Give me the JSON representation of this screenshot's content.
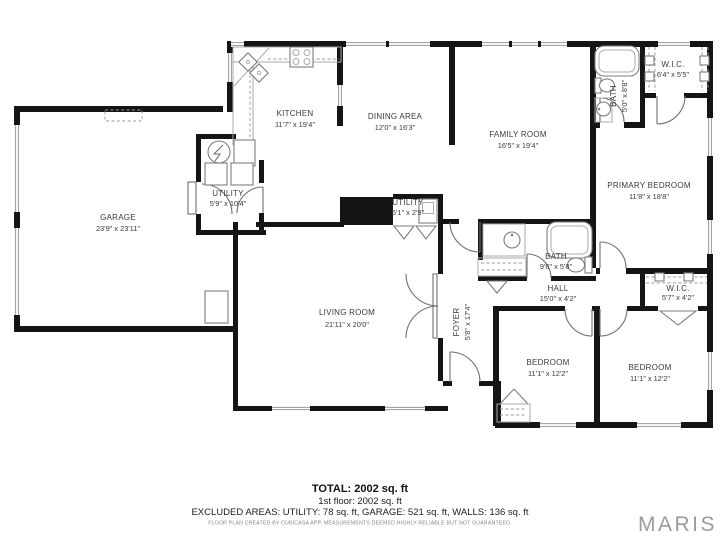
{
  "rooms": {
    "kitchen": {
      "name": "KITCHEN",
      "dims": "11'7\" x 19'4\""
    },
    "dining": {
      "name": "DINING AREA",
      "dims": "12'0\" x 16'3\""
    },
    "family": {
      "name": "FAMILY ROOM",
      "dims": "16'5\" x 19'4\""
    },
    "bath_top": {
      "name": "BATH",
      "dims": "5'0\" x 8'8\""
    },
    "wic_top": {
      "name": "W.I.C.",
      "dims": "6'4\" x 5'5\""
    },
    "primary": {
      "name": "PRIMARY BEDROOM",
      "dims": "11'8\" x 18'8\""
    },
    "garage": {
      "name": "GARAGE",
      "dims": "23'9\" x 23'11\""
    },
    "utility": {
      "name": "UTILITY",
      "dims": "5'9\" x 10'4\""
    },
    "utility_small": {
      "name": "UTILITY",
      "dims": "5'1\" x 2'9\""
    },
    "living": {
      "name": "LIVING ROOM",
      "dims": "21'11\" x 20'0\""
    },
    "foyer": {
      "name": "FOYER",
      "dims": "5'8\" x 17'4\""
    },
    "bath_mid": {
      "name": "BATH",
      "dims": "9'6\" x 5'8\""
    },
    "hall": {
      "name": "HALL",
      "dims": "15'0\" x 4'2\""
    },
    "wic_right": {
      "name": "W.I.C.",
      "dims": "5'7\" x 4'2\""
    },
    "bedroom_left": {
      "name": "BEDROOM",
      "dims": "11'1\" x 12'2\""
    },
    "bedroom_right": {
      "name": "BEDROOM",
      "dims": "11'1\" x 12'2\""
    }
  },
  "footer": {
    "total": "TOTAL: 2002 sq. ft",
    "floor": "1st floor: 2002 sq. ft",
    "excluded": "EXCLUDED AREAS: UTILITY: 78 sq. ft, GARAGE: 521 sq. ft, WALLS: 136 sq. ft",
    "disclaimer": "FLOOR PLAN CREATED BY CUBICASA APP. MEASUREMENTS DEEMED HIGHLY RELIABLE BUT NOT GUARANTEED.",
    "brand": "MARIS"
  },
  "colors": {
    "wall": "#151515",
    "fixture_outline": "#7d7d7d",
    "label_text": "#3a3a3a",
    "brand_gray": "#9b9b9b",
    "background": "#ffffff"
  }
}
